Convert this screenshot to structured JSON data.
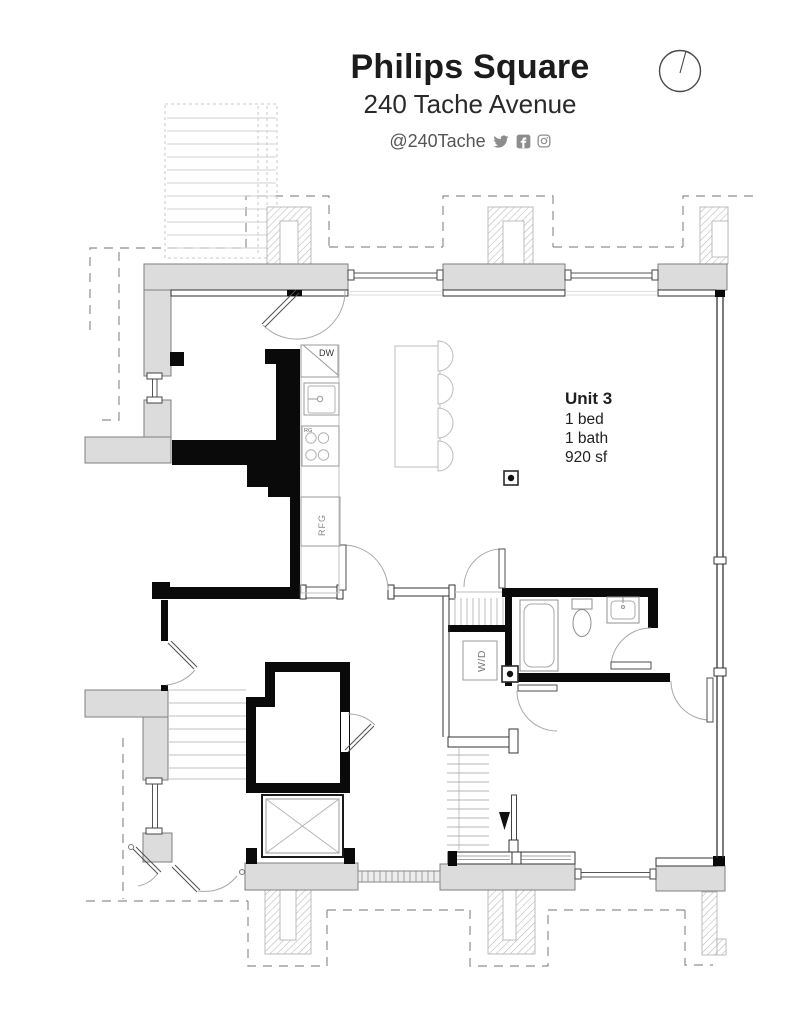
{
  "header": {
    "title": "Philips Square",
    "address": "240 Tache Avenue",
    "social_handle": "@240Tache",
    "social_icons": [
      "twitter-icon",
      "facebook-icon",
      "instagram-icon"
    ]
  },
  "unit_info": {
    "name": "Unit 3",
    "beds": "1 bed",
    "baths": "1 bath",
    "area": "920 sf"
  },
  "plan_labels": {
    "dishwasher": "DW",
    "range": "RG",
    "refrigerator": "RFG",
    "washer_dryer": "W/D"
  },
  "colors": {
    "wall_fill": "#dcdcdc",
    "wall_outline": "#7f7f7f",
    "demising_wall": "#0a0a0a",
    "fixture_stroke": "#9a9a9a",
    "dashed_overhead": "#8f8f8f",
    "hatch_line": "#b8b8b8",
    "title_text": "#1c1c1c",
    "muted_text": "#8d8d8d"
  }
}
